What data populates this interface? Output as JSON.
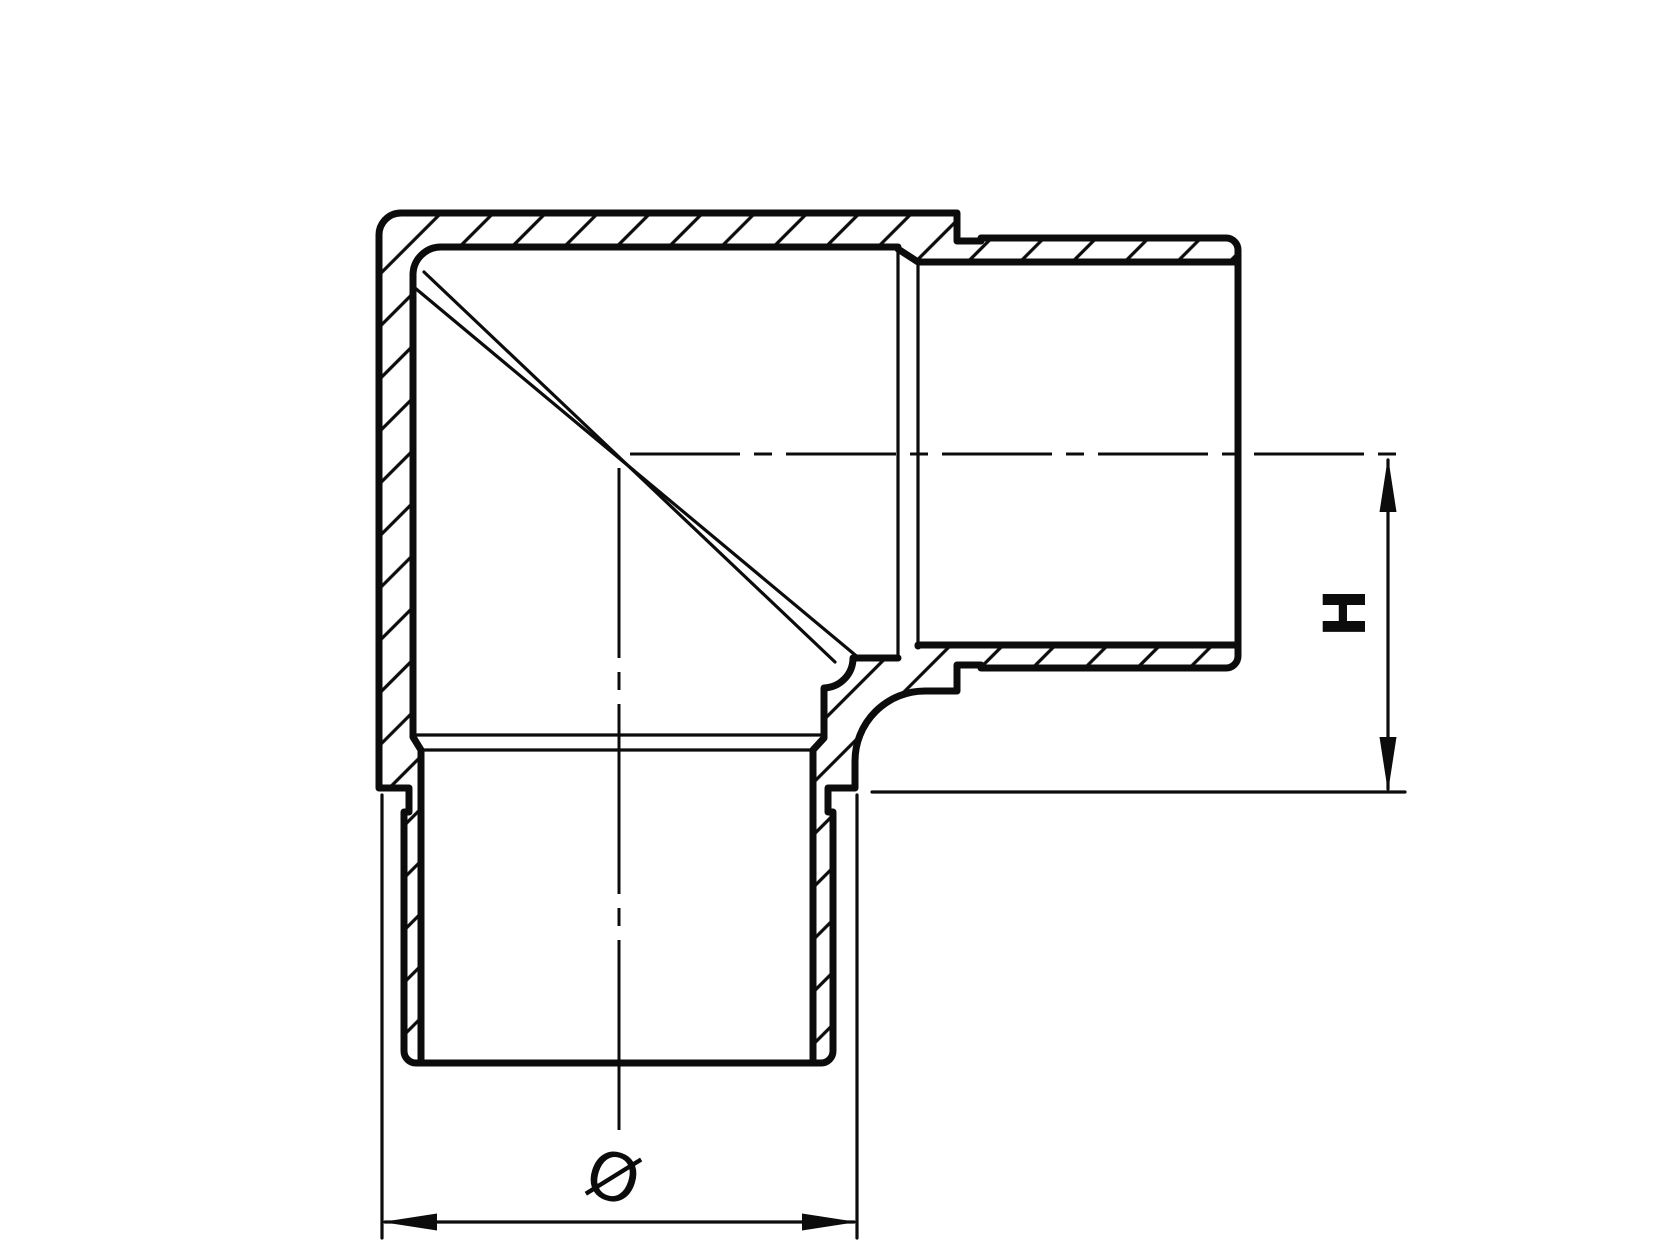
{
  "drawing": {
    "h_dimension_label": "H",
    "diameter_symbol": "Ø",
    "description": "Cross-section of a 90-degree corner elbow tube fitting with insert stubs",
    "dimensions": {
      "h_meaning": "height from horizontal leg axis to shoulder plane",
      "diameter_meaning": "outer diameter of fitting body"
    }
  },
  "colors": {
    "line": "#0c0c0c",
    "background": "#ffffff"
  }
}
